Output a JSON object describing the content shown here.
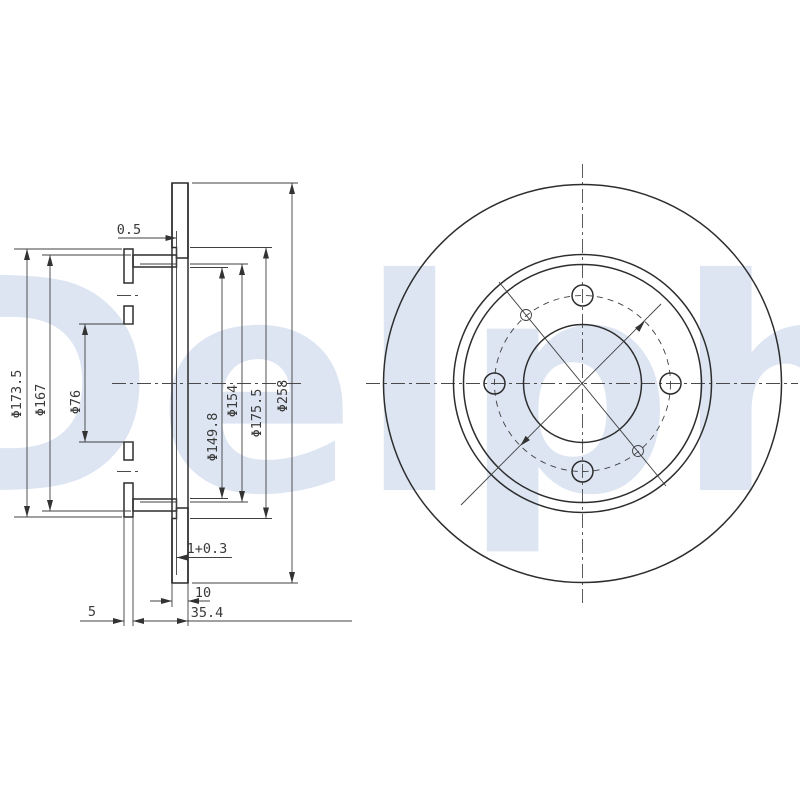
{
  "watermark_text": "Delphi",
  "section_view": {
    "diameter_labels": {
      "d173_5": "Φ173.5",
      "d167": "Φ167",
      "d76": "Φ76",
      "d149_8": "Φ149.8",
      "d154": "Φ154",
      "d175_5": "Φ175.5",
      "d258": "Φ258"
    },
    "width_labels": {
      "friction_step": "0.5",
      "hat_step": "1+0.3",
      "disc_thickness": "10",
      "overall_width": "35.4",
      "flange_thickness": "5"
    }
  }
}
